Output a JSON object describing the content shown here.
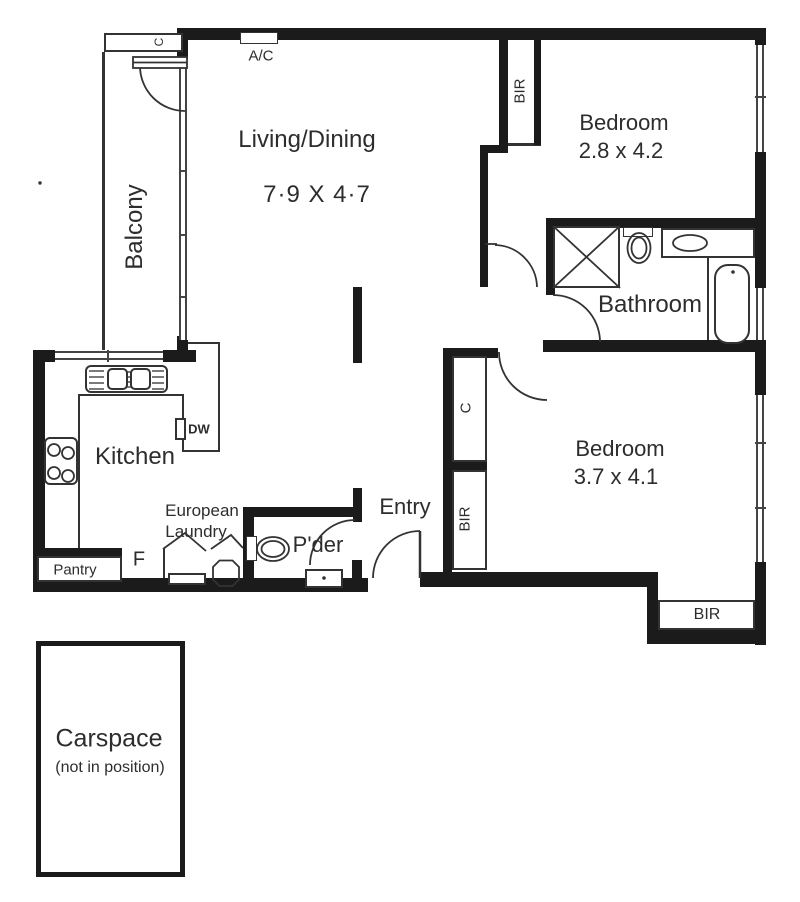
{
  "plan": {
    "living": {
      "name": "Living/Dining",
      "dims": "7·9 X 4·7"
    },
    "balcony": {
      "name": "Balcony"
    },
    "bedroom1": {
      "name": "Bedroom",
      "dims": "2.8 x 4.2"
    },
    "bedroom2": {
      "name": "Bedroom",
      "dims": "3.7 x 4.1"
    },
    "bathroom": {
      "name": "Bathroom"
    },
    "kitchen": {
      "name": "Kitchen"
    },
    "pantry": {
      "name": "Pantry"
    },
    "laundry": {
      "line1": "European",
      "line2": "Laundry"
    },
    "powder": {
      "name": "P'der"
    },
    "entry": {
      "name": "Entry"
    },
    "carspace": {
      "name": "Carspace",
      "note": "(not in position)"
    },
    "labels": {
      "ac": "A/C",
      "dw": "DW",
      "fridge": "F",
      "cupboard": "C",
      "bir": "BIR"
    }
  },
  "colors": {
    "wall": "#1b1b1b",
    "line": "#333333",
    "text": "#2d2d2d",
    "background": "#ffffff"
  }
}
